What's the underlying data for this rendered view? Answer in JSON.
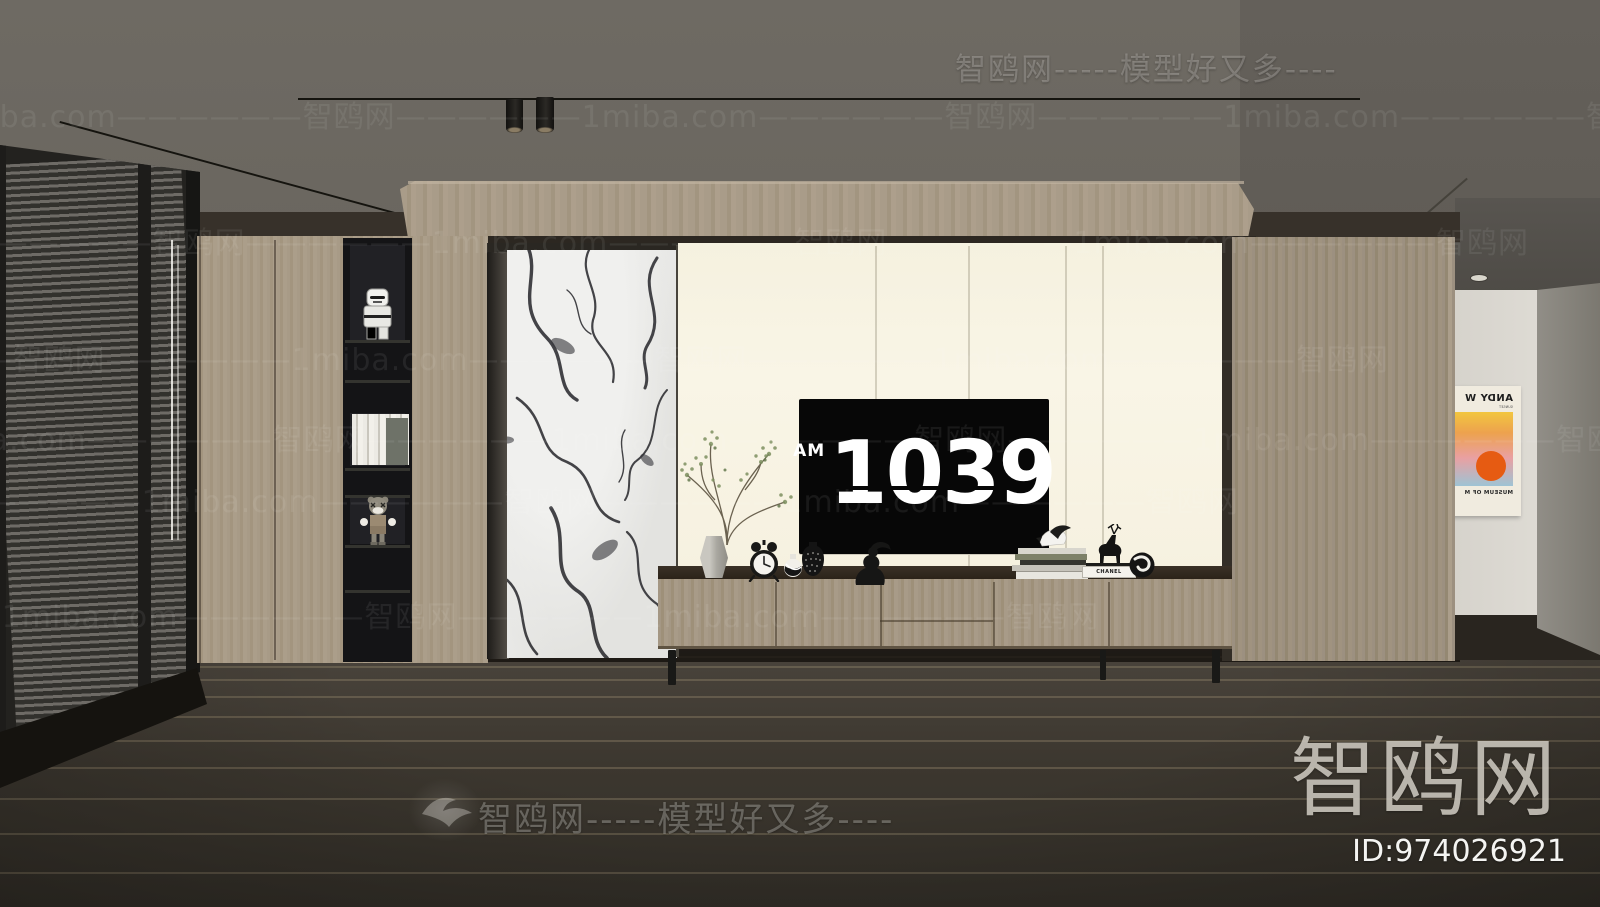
{
  "watermarks": {
    "top_row": "智鸥网-----模型好又多----",
    "bottom_row": "智鸥网-----模型好又多----",
    "tile_row": "1miba.com——————智鸥网——————1miba.com——————智鸥网——————1miba.com——————智鸥网",
    "logo_text": "智鸥网",
    "id_label": "ID:974026921"
  },
  "tv_screen": {
    "meridiem": "AM",
    "hours": "10",
    "minutes": "39"
  },
  "poster": {
    "title": "ANDY W",
    "subtitle": "SUNSET",
    "museum_line": "MUSEUM OF M"
  },
  "decor": {
    "chanel_book_label": "CHANEL"
  },
  "colors": {
    "ceiling": "#6c6861",
    "wood": "#a89b87",
    "wood_dark": "#9c9080",
    "wall_cream": "#f8f4e4",
    "marble": "#e9e9e7",
    "floor": "#45403a",
    "tv_black": "#070707",
    "poster_sun": "#e65b12",
    "shelf_black": "#141416"
  }
}
